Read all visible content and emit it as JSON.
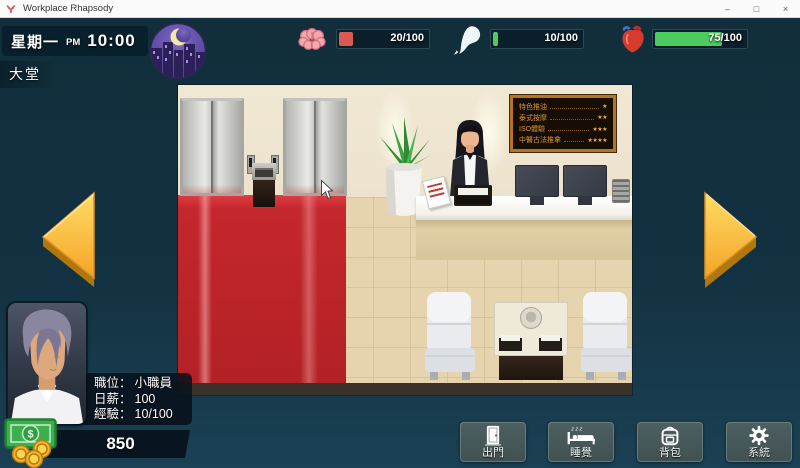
{
  "window": {
    "title": "Workplace Rhapsody",
    "minimize": "–",
    "maximize": "□",
    "close": "×"
  },
  "hud": {
    "day": "星期一",
    "meridiem": "PM",
    "time": "10:00",
    "location": "大堂",
    "stats": [
      {
        "name": "energy",
        "icon": "brain-icon",
        "value": "20/100",
        "pct": 20,
        "fill": "#d85a52"
      },
      {
        "name": "spirit",
        "icon": "spirit-icon",
        "value": "10/100",
        "pct": 10,
        "fill": "#4ecb60"
      },
      {
        "name": "health",
        "icon": "heart-icon",
        "value": "75/100",
        "pct": 75,
        "fill": "#4ecb60"
      }
    ]
  },
  "scene": {
    "signboard": [
      {
        "label": "特色推油",
        "stars": "★"
      },
      {
        "label": "泰式按摩",
        "stars": "★★"
      },
      {
        "label": "ISO體驗",
        "stars": "★★★"
      },
      {
        "label": "中醫古法推拿",
        "stars": "★★★★"
      }
    ]
  },
  "player": {
    "position_label": "職位：",
    "position_value": "小職員",
    "salary_label": "日薪：",
    "salary_value": "100",
    "exp_label": "經驗：",
    "exp_value": "10/100",
    "money": "850",
    "currency_symbol": "$"
  },
  "actions": [
    {
      "name": "go-out",
      "label": "出門"
    },
    {
      "name": "sleep",
      "label": "睡覺",
      "decor": "z z z"
    },
    {
      "name": "backpack",
      "label": "背包"
    },
    {
      "name": "system",
      "label": "系統"
    }
  ]
}
